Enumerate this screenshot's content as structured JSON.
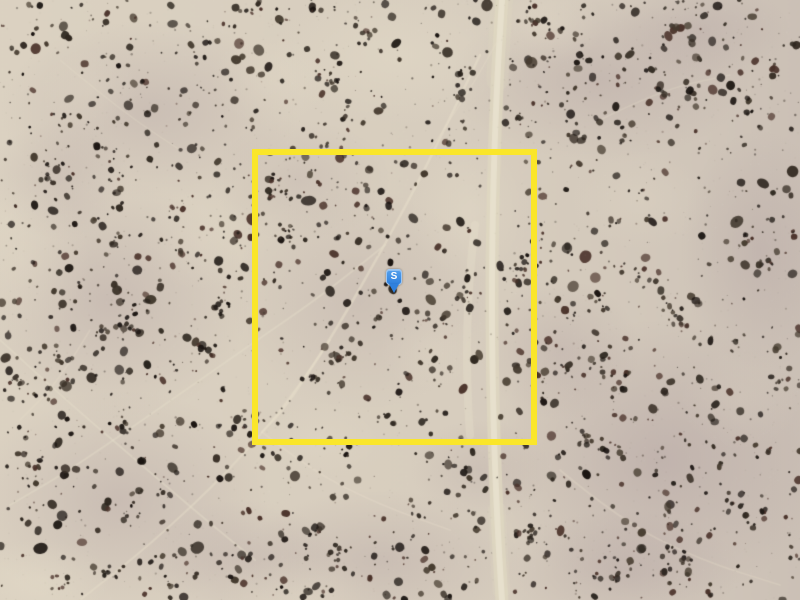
{
  "map": {
    "view_type": "satellite aerial imagery, desert parcel",
    "marker": {
      "label": "S",
      "x": 394,
      "y": 293,
      "fill_color": "#2F80DD",
      "fill_color_top": "#55A0EC",
      "border_color": "#9CC6F2",
      "label_color": "#FFFFFF"
    },
    "parcel_boundary": {
      "shape": "rectangle",
      "left": 252,
      "top": 149,
      "width": 285,
      "height": 296,
      "stroke_width": 6,
      "stroke_color": "#FAE62A"
    },
    "terrain": {
      "base_color": "#D7CDBE",
      "highlight_color": "#EBE3CE",
      "mauve_patch_color": "#9E8A92",
      "shadow_tint_color": "#968690",
      "trail_color": "#E7DECA",
      "shrub_colors": [
        "#241E19",
        "#2F2820",
        "#3A3128",
        "#1A1411",
        "#453B2F",
        "#4A322A"
      ],
      "road": {
        "orientation": "vertical",
        "center_x_top": 502,
        "center_x_mid": 492,
        "center_x_bottom": 502,
        "width": 13,
        "color": "#DFD7C1",
        "center_line_color": "#E9E2CF"
      }
    }
  }
}
